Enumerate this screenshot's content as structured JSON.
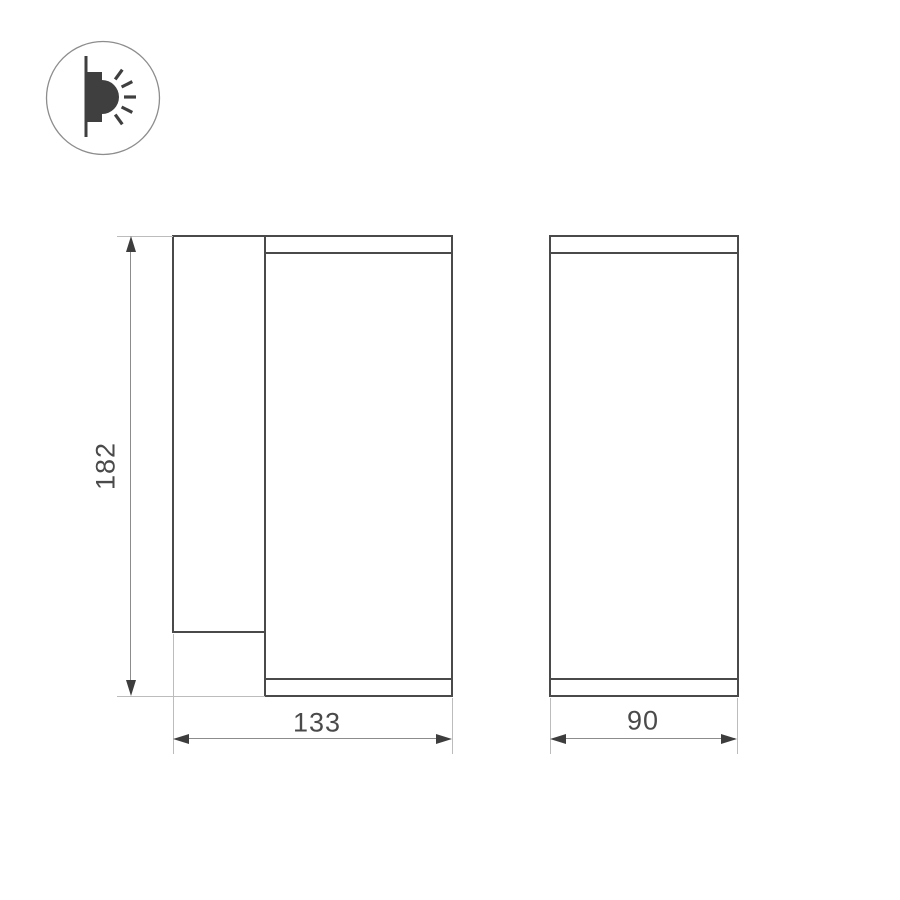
{
  "page": {
    "background_color": "#ffffff",
    "description": "Technical dimension drawing of a wall-mounted cylindrical luminaire, side view and front view"
  },
  "icon_legend": {
    "name": "wall-mounted-light-icon",
    "meaning": "surface wall mount fixture emitting light sideways"
  },
  "drawing": {
    "type": "technical-dimension-drawing",
    "views": {
      "side_view": {
        "name": "side view",
        "height_dimension": {
          "value": "182"
        },
        "width_dimension": {
          "value": "133"
        }
      },
      "front_view": {
        "name": "front view",
        "width_dimension": {
          "value": "90"
        }
      }
    },
    "colors": {
      "background_color": "#ffffff",
      "outline_color": "#4a4a4a",
      "extension_color": "#bcbcbc",
      "dimension_color": "#8c8c8c",
      "arrow_color": "#3d3d3d",
      "label_color": "#4a4a4a",
      "icon_color": "#3f3f3f",
      "circle_stroke_color": "#8d8d8d"
    }
  }
}
